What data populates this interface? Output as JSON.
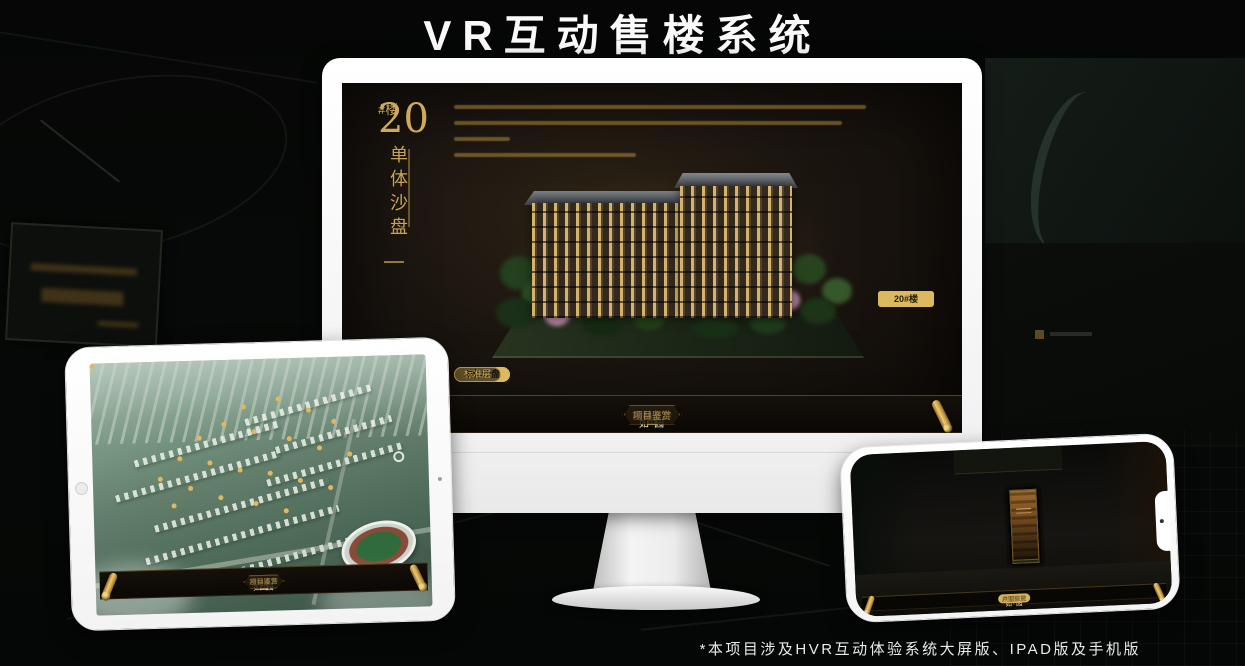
{
  "header": {
    "title": "VR互动售楼系统"
  },
  "footer": {
    "note": "*本项目涉及HVR互动体验系统大屏版、IPAD版及手机版"
  },
  "colors": {
    "gold": "#d8b35f",
    "gold_deep": "#b9923f",
    "screen_bg": "#1a140d",
    "device_white": "#f4f4f4"
  },
  "app_nav": {
    "items": [
      "区位交通",
      "三维沙盘",
      "样板间VR",
      "户型鉴赏",
      "园林漫游",
      "项目鉴赏"
    ],
    "logo_text": "如·园"
  },
  "monitor_app": {
    "floor_heading_number": "20",
    "floor_heading_suffix": "#楼",
    "floor_heading_title": "单体沙盘",
    "view_tabs": [
      "项目沙盘",
      "单体沙盘",
      "标准层"
    ],
    "active_view_tab": "单体沙盘",
    "floor_buttons": [
      "3#楼",
      "6#楼",
      "8#楼",
      "20#楼"
    ],
    "active_floor_button": "20#楼",
    "active_nav_item": "三维沙盘"
  },
  "tablet_app": {
    "view_tabs": [
      "项目沙盘",
      "单体沙盘",
      "标准层"
    ],
    "active_view_tab": "项目沙盘",
    "active_nav_item": "三维沙盘"
  },
  "phone_app": {
    "active_nav_item": "户型鉴赏"
  }
}
